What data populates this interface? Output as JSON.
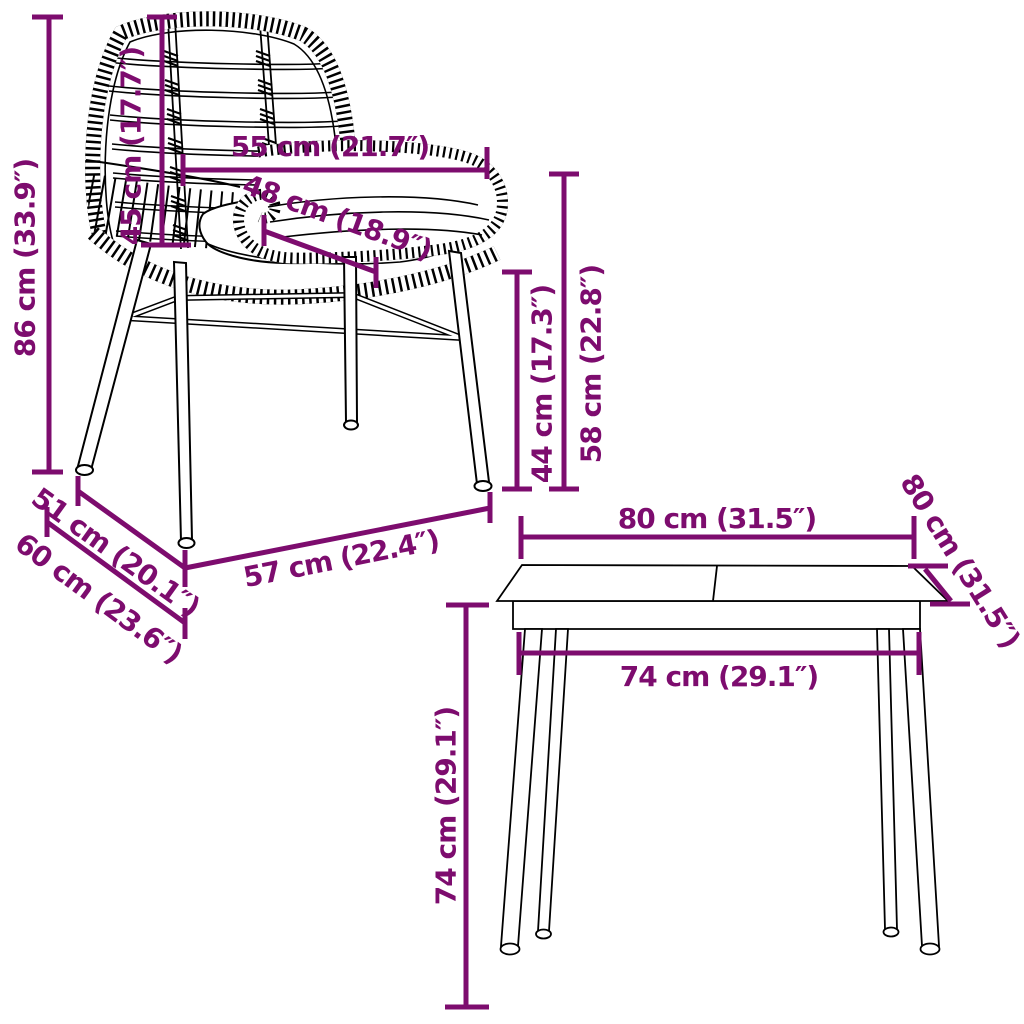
{
  "accent_color": "#7d0c6e",
  "line_color": "#000000",
  "background_color": "#ffffff",
  "figure": "furniture dimension diagram of a rattan dining chair and a square dining table",
  "chair": {
    "dims": {
      "height": "86 cm (33.9″)",
      "backrest_height": "45 cm (17.7″)",
      "width": "55 cm (21.7″)",
      "seat_depth": "48 cm (18.9″)",
      "seat_height": "44 cm (17.3″)",
      "armrest_height": "58 cm (22.8″)",
      "front_depth": "57 cm (22.4″)",
      "side_depth": "51 cm (20.1″)",
      "total_depth": "60 cm (23.6″)"
    }
  },
  "table": {
    "dims": {
      "top_width": "80 cm (31.5″)",
      "top_depth": "80 cm (31.5″)",
      "leg_span": "74 cm (29.1″)",
      "height": "74 cm (29.1″)"
    }
  }
}
